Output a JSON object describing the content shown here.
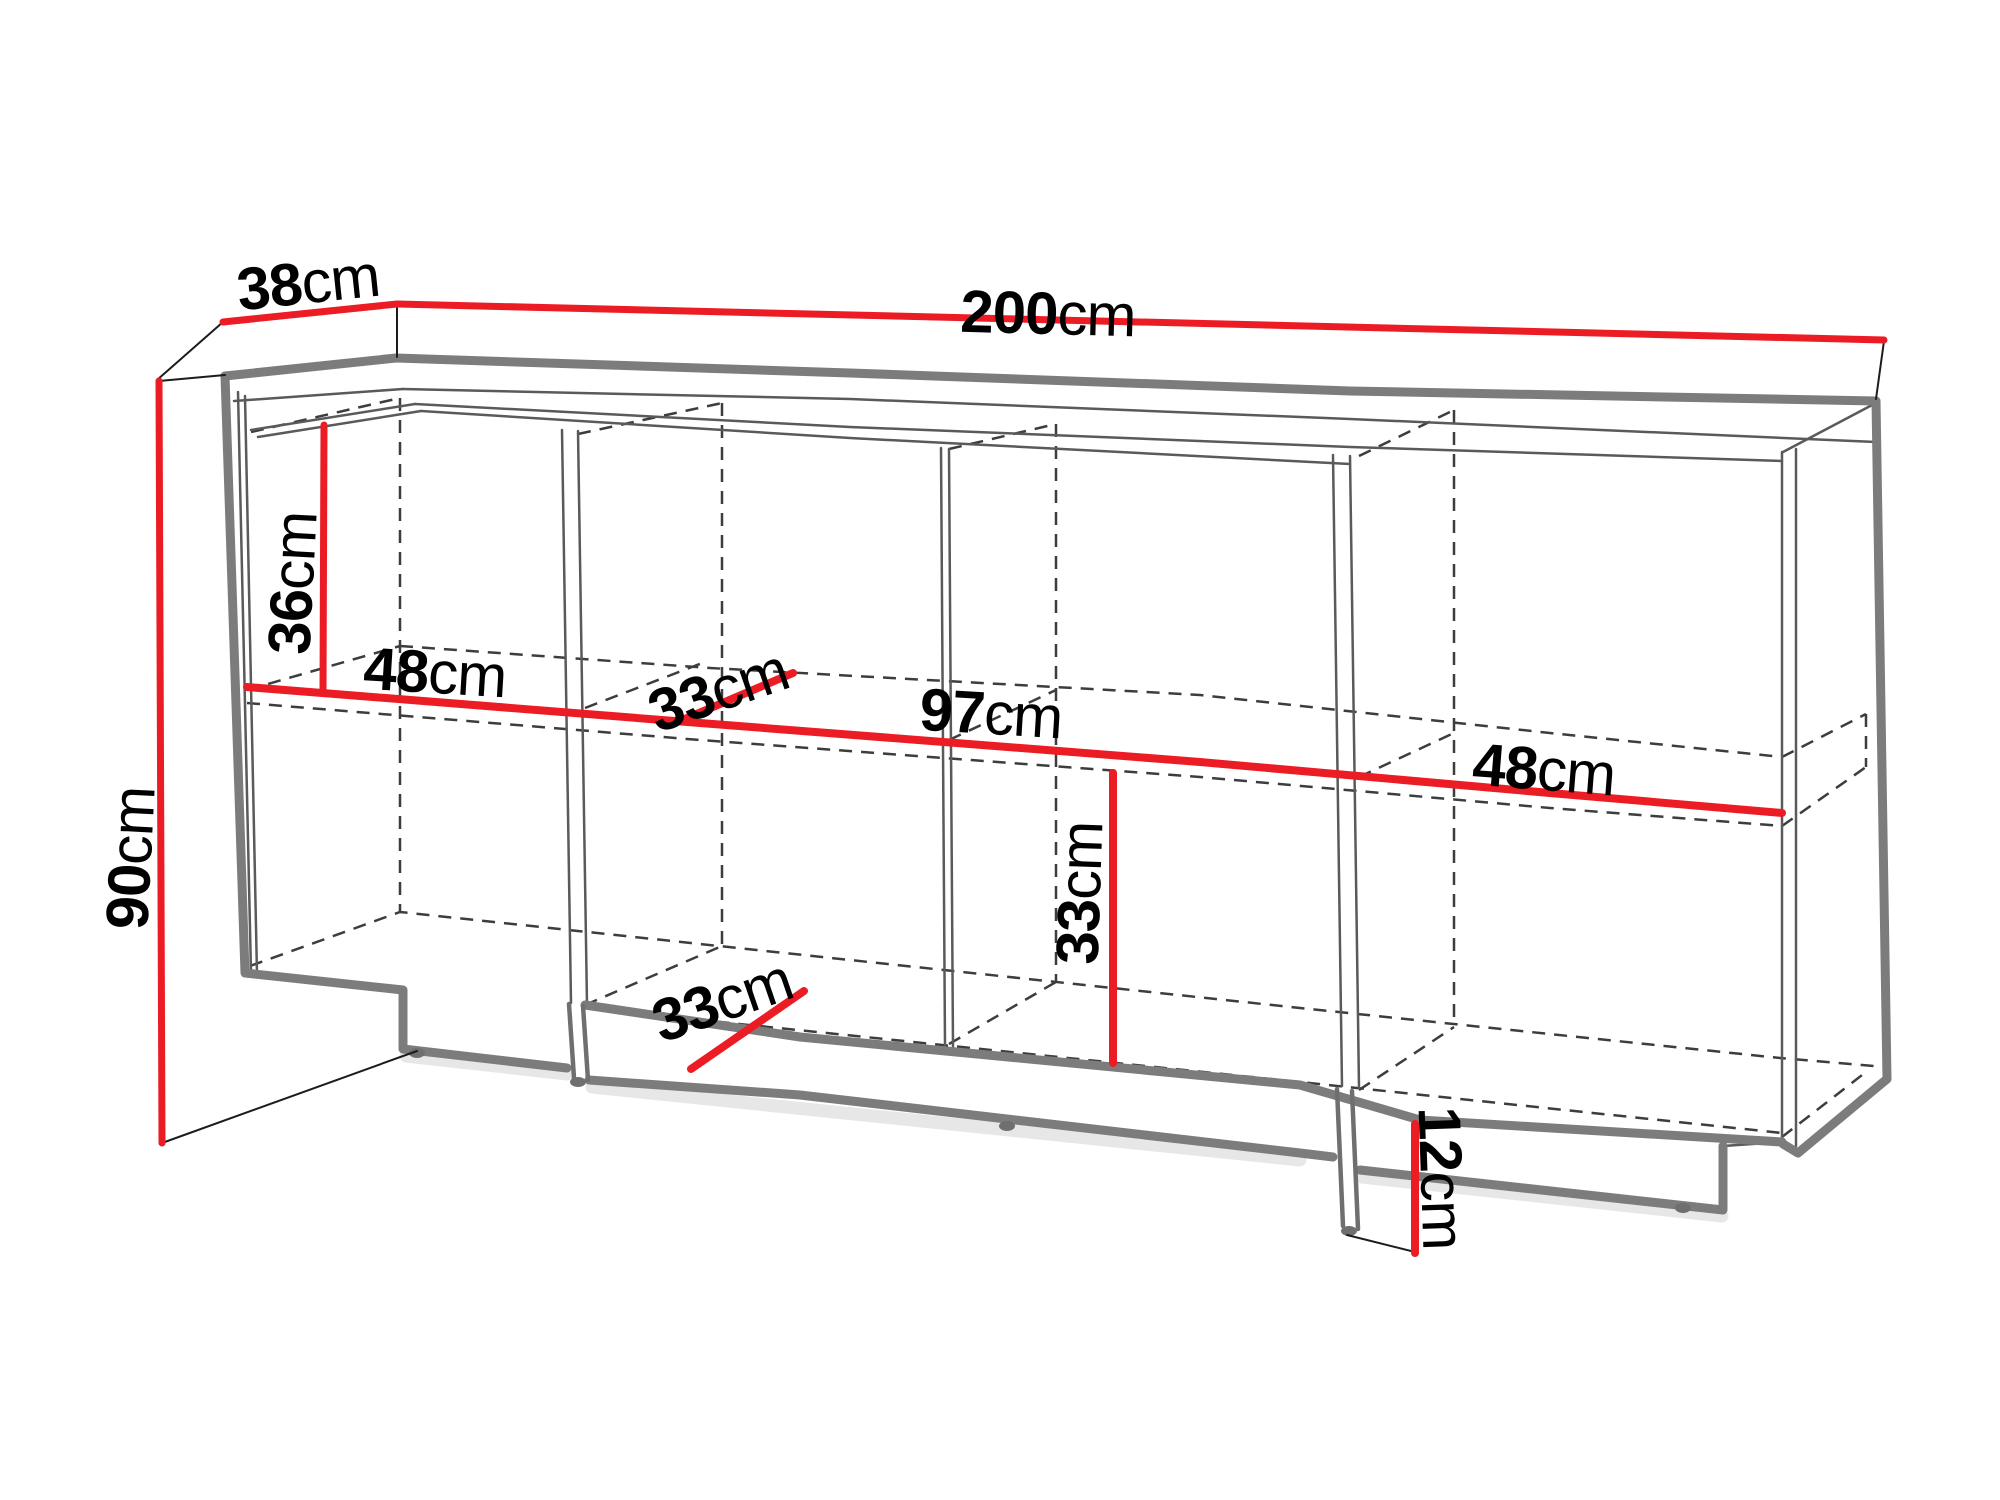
{
  "diagram": {
    "dimensions": [
      {
        "name": "top-depth",
        "value": "38",
        "unit": "cm"
      },
      {
        "name": "top-width",
        "value": "200",
        "unit": "cm"
      },
      {
        "name": "left-height",
        "value": "90",
        "unit": "cm"
      },
      {
        "name": "upper-compartment-height",
        "value": "36",
        "unit": "cm"
      },
      {
        "name": "left-shelf-width",
        "value": "48",
        "unit": "cm"
      },
      {
        "name": "upper-shelf-depth",
        "value": "33",
        "unit": "cm"
      },
      {
        "name": "middle-width",
        "value": "97",
        "unit": "cm"
      },
      {
        "name": "right-shelf-width",
        "value": "48",
        "unit": "cm"
      },
      {
        "name": "lower-shelf-depth",
        "value": "33",
        "unit": "cm"
      },
      {
        "name": "lower-compartment-height",
        "value": "33",
        "unit": "cm"
      },
      {
        "name": "plinth-height",
        "value": "12",
        "unit": "cm"
      }
    ],
    "colors": {
      "dimension_line": "#ec1c24",
      "outline": "#7c7c7c",
      "thin_line": "#5a5a5a",
      "hidden_line": "#3d3d3d",
      "label_text": "#000000",
      "background": "#ffffff"
    }
  }
}
